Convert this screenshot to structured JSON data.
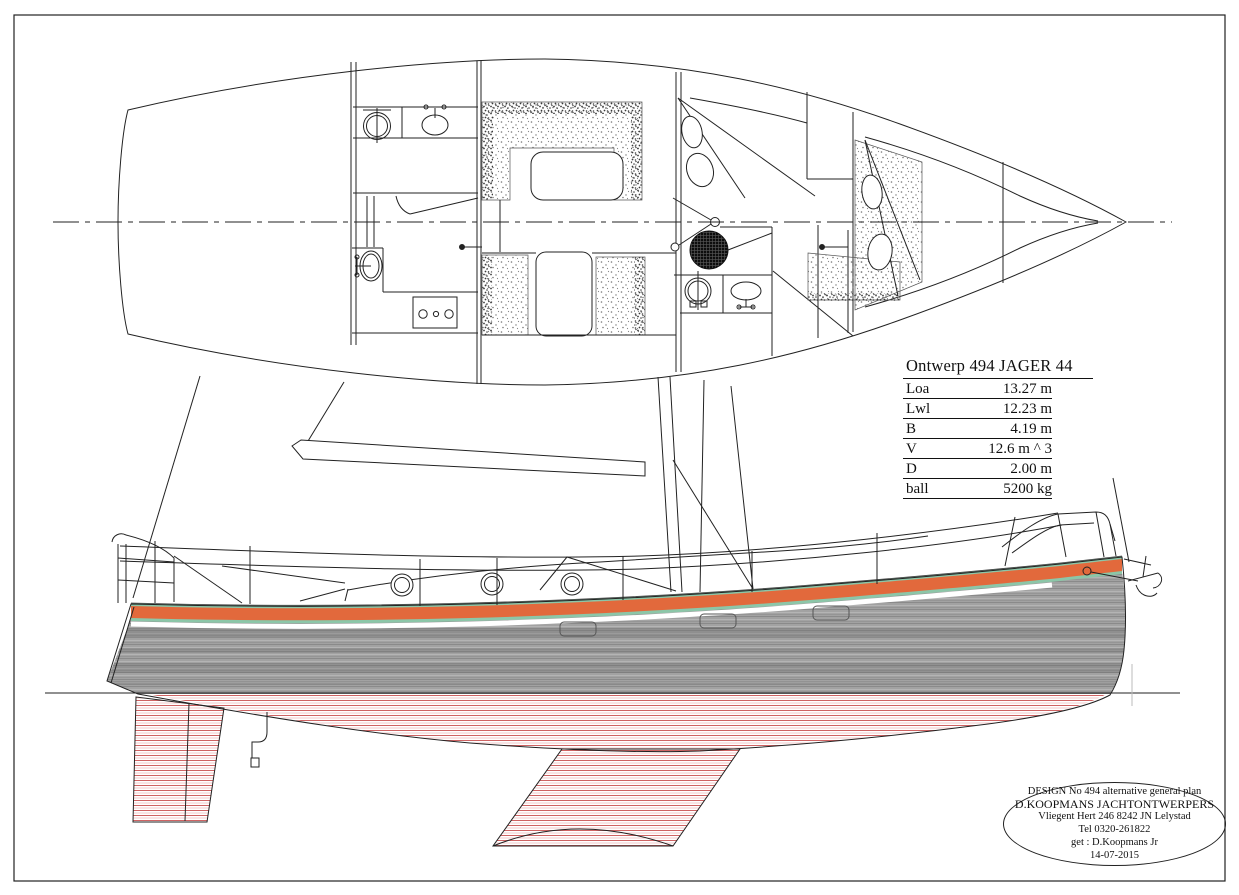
{
  "spec_table": {
    "title": "Ontwerp 494 JAGER 44",
    "rows": [
      {
        "label": "Loa",
        "value": "13.27 m"
      },
      {
        "label": "Lwl",
        "value": "12.23 m"
      },
      {
        "label": "B",
        "value": "4.19 m"
      },
      {
        "label": "V",
        "value": "12.6 m ^ 3"
      },
      {
        "label": "D",
        "value": "2.00 m"
      },
      {
        "label": "ball",
        "value": "5200 kg"
      }
    ]
  },
  "title_block": {
    "lines": [
      "DESIGN No 494 alternative general plan",
      "D.KOOPMANS  JACHTONTWERPERS",
      "Vliegent Hert 246 8242 JN Lelystad",
      "Tel 0320-261822",
      "get : D.Koopmans Jr",
      "14-07-2015"
    ]
  },
  "colors": {
    "line": "#222222",
    "background": "#ffffff",
    "sheer_stripe": "#e2693c",
    "stripe_trim": "#8cc6a8",
    "hull_gray": "#a2a2a2",
    "hull_gray_dark": "#8a8a8a",
    "hull_gray_light": "#b4b4b4",
    "underwater_red": "#cf6363",
    "underwater_red_light": "#f0bcbc"
  }
}
